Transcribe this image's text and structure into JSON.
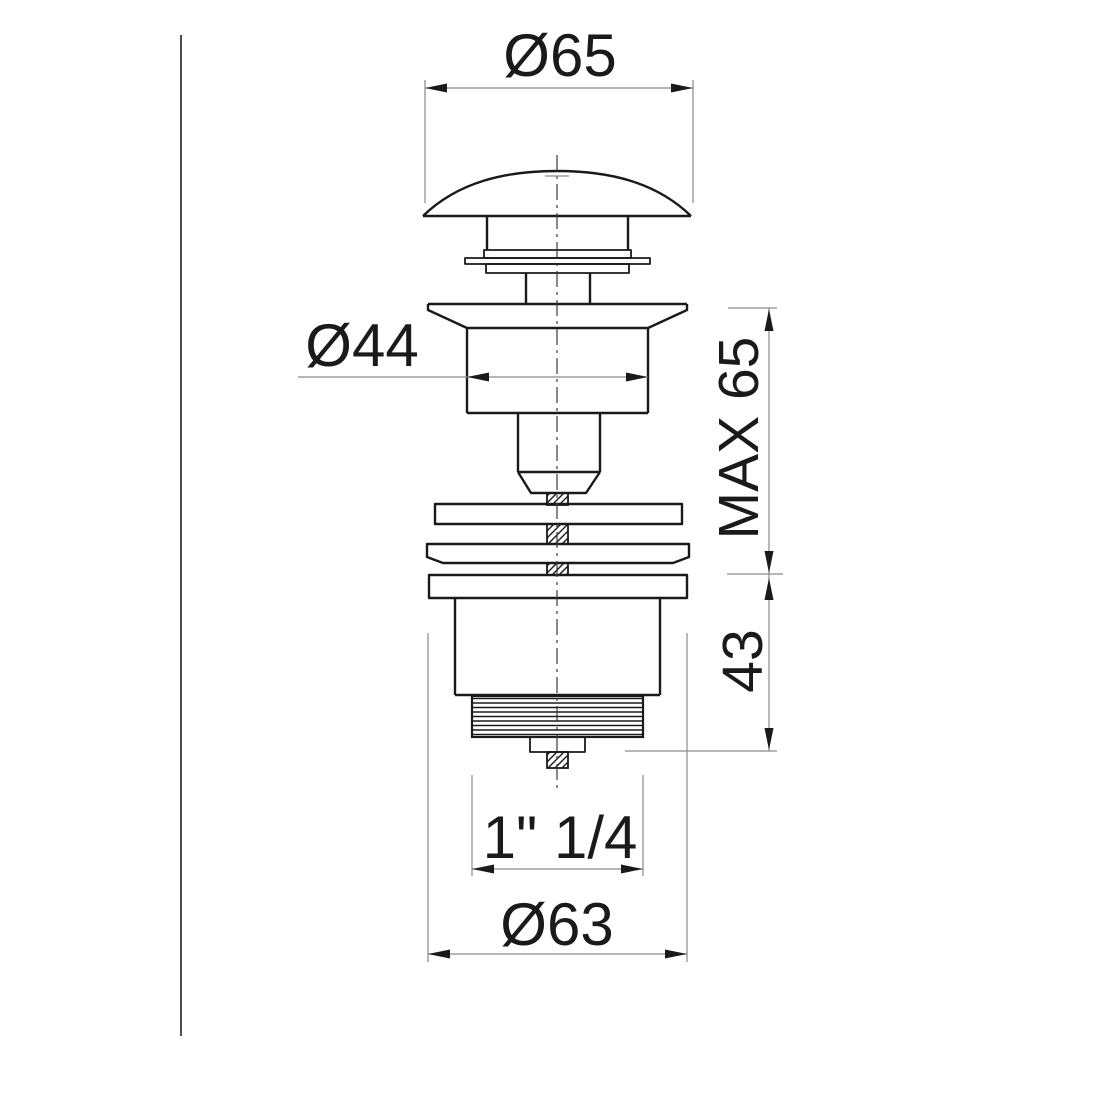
{
  "drawing": {
    "type": "technical-dimension-drawing",
    "subject": "basin pop-up waste drain valve, side elevation",
    "labels": {
      "cap_diameter": "Ø65",
      "body_diameter": "Ø44",
      "max_clamp_height": "MAX 65",
      "lower_height": "43",
      "thread_size": "1\" 1/4",
      "flange_diameter": "Ø63"
    },
    "colors": {
      "line": "#1a1a1a",
      "dimension": "#8a8a8a",
      "background": "#ffffff",
      "border": "#4d4d4d",
      "centerline": "#3a3a3a"
    }
  }
}
